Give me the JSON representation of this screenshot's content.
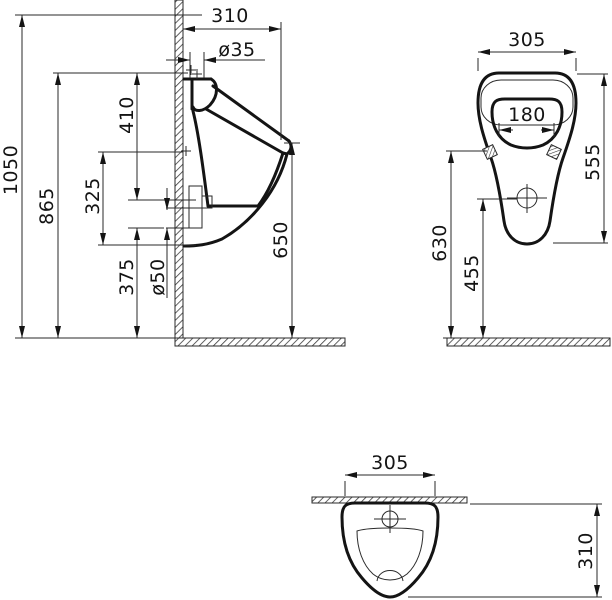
{
  "title": "wall-hung urinal technical drawing",
  "side_view": {
    "depth": "310",
    "inlet_diameter": "ø35",
    "overall_height": "1050",
    "mounting_height": "865",
    "inlet_to_outlet": "410",
    "outlet_span": "325",
    "outlet_height": "375",
    "outlet_diameter": "ø50",
    "rim_height": "650"
  },
  "front_view": {
    "width": "305",
    "opening_width": "180",
    "body_height": "555",
    "fixing_height": "630",
    "drain_center_height": "455"
  },
  "top_view": {
    "width": "305",
    "depth": "310"
  },
  "colors": {
    "line": "#141414",
    "background": "#ffffff"
  }
}
